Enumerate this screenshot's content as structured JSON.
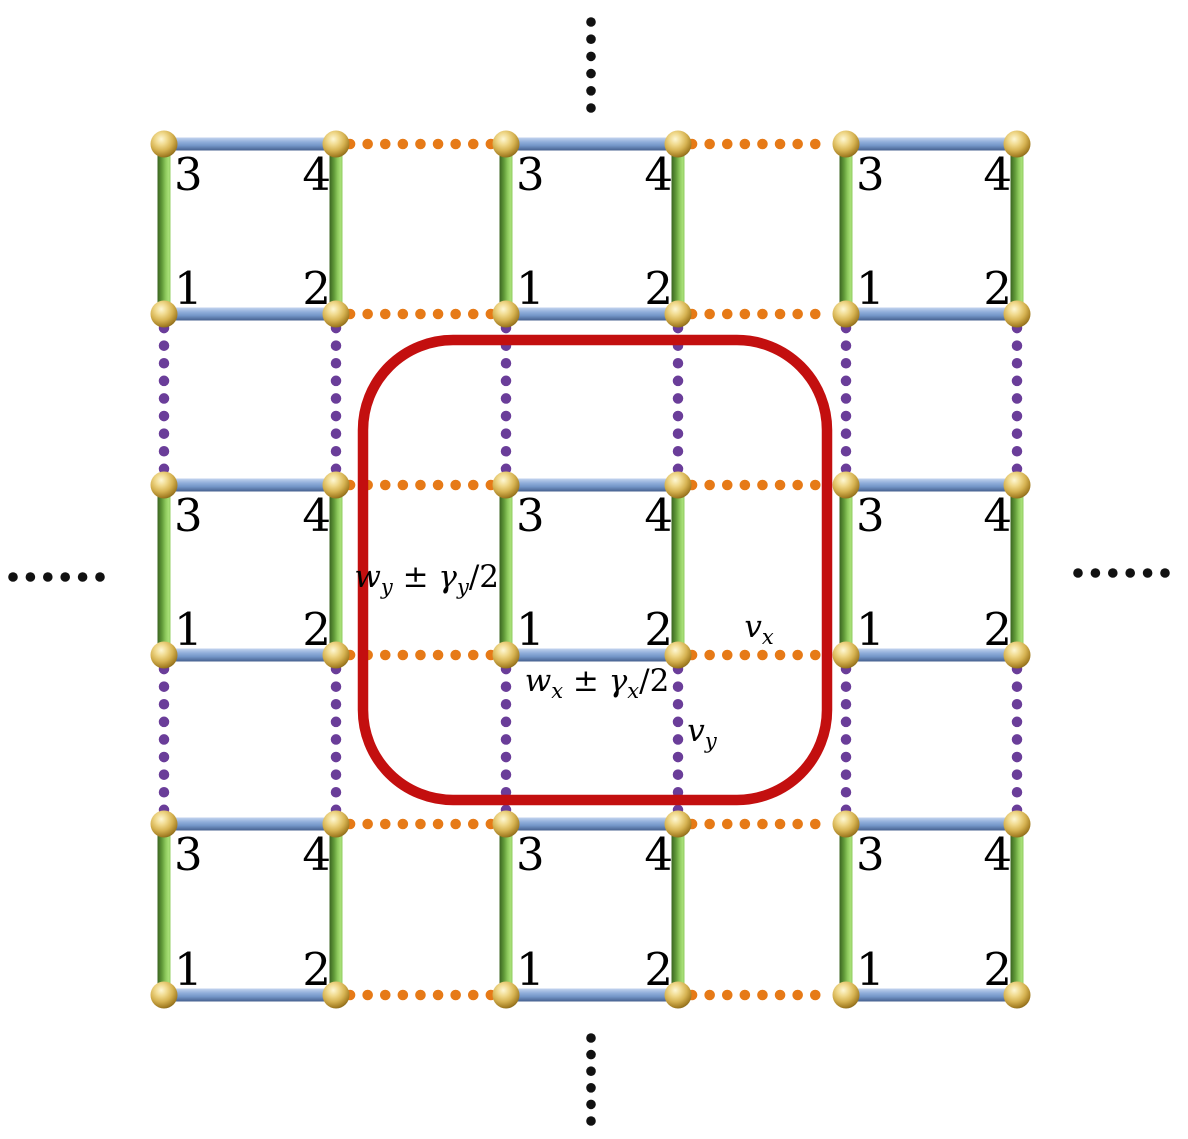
{
  "figure": {
    "kind": "2D SSH-type lattice model diagram",
    "visible_text": [
      "3",
      "4",
      "1",
      "2",
      "wy ± γy/2",
      "wx ± γx/2",
      "vx",
      "vy"
    ]
  },
  "lattice": {
    "canvas": {
      "width": 1188,
      "height": 1139
    },
    "colors": {
      "background": "#ffffff",
      "intercell_x": "#e67a17",
      "intercell_y": "#6a3d99",
      "unit_cell_outline": "#c30f0f",
      "ellipsis": "#111111",
      "site_label": "#000000",
      "bond_x_stops": [
        [
          "0",
          "#c3d4ee"
        ],
        [
          "0.35",
          "#8fadda"
        ],
        [
          "0.62",
          "#7496c8"
        ],
        [
          "1",
          "#46608e"
        ]
      ],
      "bond_y_stops": [
        [
          "0",
          "#3a6421"
        ],
        [
          "0.35",
          "#619a39"
        ],
        [
          "0.62",
          "#8cc85c"
        ],
        [
          "0.85",
          "#a8df77"
        ],
        [
          "1",
          "#90cc60"
        ]
      ],
      "sphere_stops": [
        [
          "0",
          "#fdf7d4"
        ],
        [
          "0.28",
          "#f0d98c"
        ],
        [
          "0.55",
          "#d6b352"
        ],
        [
          "0.8",
          "#a78126"
        ],
        [
          "1",
          "#6f5511"
        ]
      ]
    },
    "geometry": {
      "node_columns": [
        164,
        336,
        506,
        678,
        846,
        1017
      ],
      "node_rows": [
        144,
        314,
        485,
        655,
        824,
        995
      ],
      "cell_pairs": [
        [
          0,
          1
        ],
        [
          2,
          3
        ],
        [
          4,
          5
        ]
      ],
      "gap_pairs": [
        [
          1,
          2
        ],
        [
          3,
          4
        ]
      ],
      "sphere_radius": 13.5,
      "bond_thickness": 13,
      "dot_diameter": 10.5,
      "dot_spacing": 17.5,
      "dot_inset": 14,
      "ellipsis_dot_radius": 4.8,
      "site_label_font_size": 45,
      "coupling_font_size": 31,
      "coupling_sub_font_size": 21,
      "sub_offset": 7,
      "site_label_offsets": {
        "dx_start": 10,
        "dx_end": -5,
        "dy_top": 46,
        "dy_bottom": -10
      }
    },
    "unit_cell_box": {
      "x": 363,
      "y": 340,
      "width": 464,
      "height": 460,
      "radius": 90,
      "stroke_width": 10.5
    },
    "site_labels": {
      "top_left": "3",
      "top_right": "4",
      "bottom_left": "1",
      "bottom_right": "2"
    },
    "coupling_labels": [
      {
        "name": "coupling-label-wy",
        "text": "wy ± γy/2",
        "anchor": "end",
        "x": 499,
        "y": 587,
        "parts": [
          {
            "t": "w",
            "i": 1
          },
          {
            "t": "y",
            "i": 1,
            "s": 1
          },
          {
            "t": " ± ",
            "i": 0
          },
          {
            "t": "γ",
            "i": 1
          },
          {
            "t": "y",
            "i": 1,
            "s": 1
          },
          {
            "t": "/2",
            "i": 0
          }
        ]
      },
      {
        "name": "coupling-label-wx",
        "text": "wx ± γx/2",
        "anchor": "middle",
        "x": 597,
        "y": 691,
        "parts": [
          {
            "t": "w",
            "i": 1
          },
          {
            "t": "x",
            "i": 1,
            "s": 1
          },
          {
            "t": " ± ",
            "i": 0
          },
          {
            "t": "γ",
            "i": 1
          },
          {
            "t": "x",
            "i": 1,
            "s": 1
          },
          {
            "t": "/2",
            "i": 0
          }
        ]
      },
      {
        "name": "coupling-label-vx",
        "text": "vx",
        "anchor": "middle",
        "x": 759,
        "y": 637,
        "parts": [
          {
            "t": "v",
            "i": 1
          },
          {
            "t": "x",
            "i": 1,
            "s": 1
          }
        ]
      },
      {
        "name": "coupling-label-vy",
        "text": "vy",
        "anchor": "middle",
        "x": 702,
        "y": 741,
        "parts": [
          {
            "t": "v",
            "i": 1
          },
          {
            "t": "y",
            "i": 1,
            "s": 1
          }
        ]
      }
    ],
    "ellipses": [
      {
        "name": "ellipsis-top",
        "direction": "vertical",
        "x": 591,
        "y": 22,
        "count": 6,
        "spacing": 17.2
      },
      {
        "name": "ellipsis-bottom",
        "direction": "vertical",
        "x": 591,
        "y": 1038,
        "count": 6,
        "spacing": 16.6
      },
      {
        "name": "ellipsis-left",
        "direction": "horizontal",
        "x": 13,
        "y": 577,
        "count": 6,
        "spacing": 17.4
      },
      {
        "name": "ellipsis-right",
        "direction": "horizontal",
        "x": 1078,
        "y": 573,
        "count": 6,
        "spacing": 17.4
      }
    ]
  }
}
